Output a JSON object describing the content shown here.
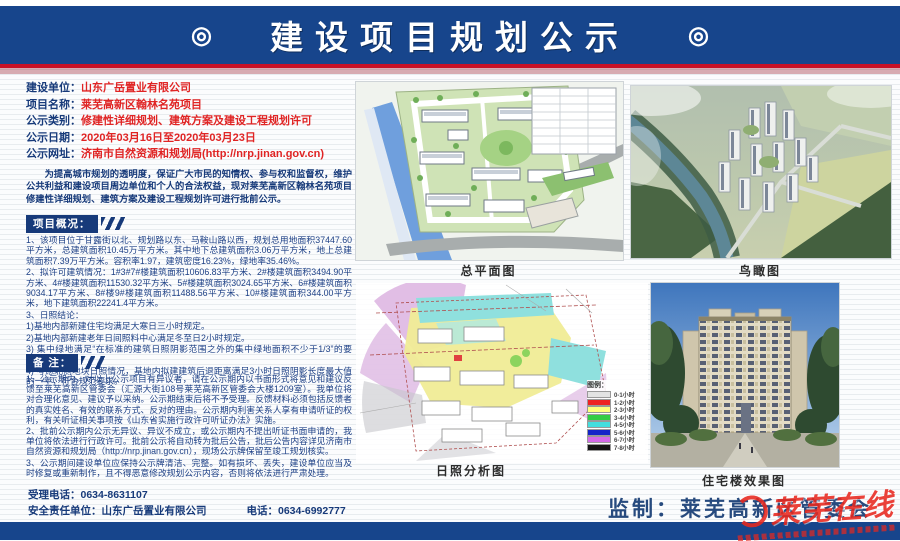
{
  "header": {
    "title": "建设项目规划公示",
    "ornament": "◎"
  },
  "info": {
    "rows": [
      {
        "label": "建设单位：",
        "value": "山东广岳置业有限公司"
      },
      {
        "label": "项目名称：",
        "value": "莱芜高新区翰林名苑项目"
      },
      {
        "label": "公示类别：",
        "value": "修建性详细规划、建筑方案及建设工程规划许可"
      },
      {
        "label": "公示日期：",
        "value": "2020年03月16日至2020年03月23日"
      },
      {
        "label": "公示网址：",
        "value": "济南市自然资源和规划局(http://nrp.jinan.gov.cn)"
      }
    ],
    "intro": "为提高城市规划的透明度，保证广大市民的知情权、参与权和监督权，维护公共利益和建设项目周边单位和个人的合法权益，现对莱芜高新区翰林名苑项目修建性详细规划、建筑方案及建设工程规划许可进行批前公示。"
  },
  "overview": {
    "heading": "项目概况：",
    "lines": [
      "1、该项目位于甘露街以北、规划路以东、马鞍山路以西，规划总用地面积37447.60平方米，总建筑面积10.45万平方米。其中地下总建筑面积3.06万平方米，地上总建筑面积7.39万平方米。容积率1.97，建筑密度16.23%，绿地率35.46%。",
      "2、拟许可建筑情况：1#3#7#楼建筑面积10606.83平方米、2#楼建筑面积3494.90平方米、4#楼建筑面积11530.32平方米、5#楼建筑面积3024.65平方米、6#楼建筑面积9034.17平方米、8#楼9#楼建筑面积11488.56平方米、10#楼建筑面积344.00平方米，地下建筑面积22241.4平方米。",
      "3、日照结论：",
      "1)基地内部新建住宅均满足大寒日三小时规定。",
      "2)基地内部新建老年日间照料中心满足冬至日2小时规定。",
      "3) 集中绿地满足“在标准的建筑日照阴影范围之外的集中绿地面积不少于1/3”的要求。",
      "4) 考虑北侧地块日照情况，基地内拟建建筑后退距离满足3小时日照阴影长度最大值的一半，符合规范要求。"
    ]
  },
  "notes": {
    "heading": "备 注：",
    "lines": [
      "1、公示期内，对以上公示项目有异议者，请在公示期内以书面形式将意见和建议反馈至莱芜高新区管委会（汇源大街108号莱芜高新区管委会大楼1209室）。我单位将对合理化意见、建议予以采纳。公示期结束后将不予受理。反馈材料必须包括反馈者的真实姓名、有效的联系方式、反对的理由。公示期内利害关系人享有申请听证的权利，有关听证相关事项按《山东省实施行政许可听证办法》实施。",
      "2、批前公示期内公示无异议、异议不成立，或公示期内不提出听证书面申请的，我单位将依法进行行政许可。批前公示将自动转为批后公告，批后公告内容详见济南市自然资源和规划局（http://nrp.jinan.gov.cn），现场公示牌保留至竣工规划核实。",
      "3、公示期间建设单位应保持公示牌清洁、完整。如有损坏、丢失，建设单位应当及时修复或重新制作，且不得恶意修改规划公示内容，否则将依法进行严肃处理。"
    ]
  },
  "figures": {
    "site_plan_caption": "总平面图",
    "bird_view_caption": "鸟瞰图",
    "sunshine_caption": "日照分析图",
    "render_caption": "住宅楼效果图",
    "legend_title": "图例：",
    "legend": [
      {
        "label": "0-1小时",
        "color": "#e3e3e3"
      },
      {
        "label": "1-2小时",
        "color": "#ee2222"
      },
      {
        "label": "2-3小时",
        "color": "#ffff7d"
      },
      {
        "label": "3-4小时",
        "color": "#33cc44"
      },
      {
        "label": "4-5小时",
        "color": "#44dede"
      },
      {
        "label": "5-6小时",
        "color": "#1424c8"
      },
      {
        "label": "6-7小时",
        "color": "#d46ae8"
      },
      {
        "label": "7-8小时",
        "color": "#141414"
      }
    ]
  },
  "footer": {
    "phone_line": "受理电话：0634-8631107",
    "safety_unit": "安全责任单位：山东广岳置业有限公司",
    "safety_phone": "电话：0634-6992777",
    "supervisor": "监制：莱芜高新区管委会"
  },
  "watermark": {
    "text": "莱芜在线"
  }
}
